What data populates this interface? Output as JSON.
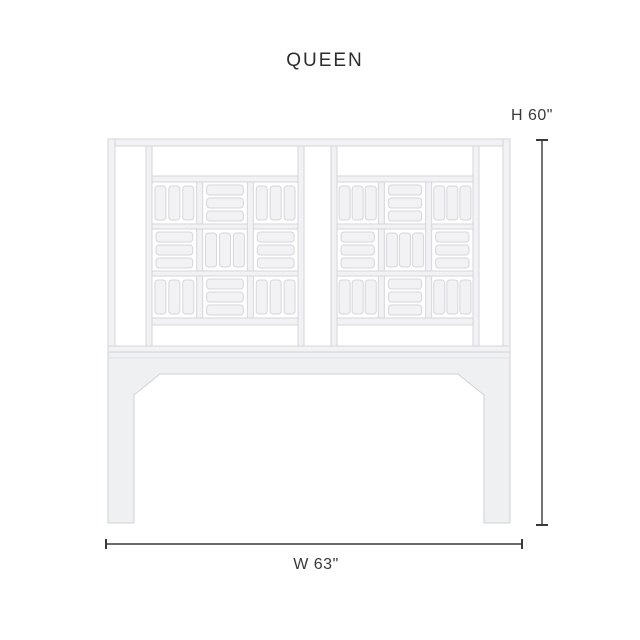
{
  "title": "QUEEN",
  "dimensions": {
    "height_label": "H 60\"",
    "width_label": "W 63\""
  },
  "diagram": {
    "product": "headboard",
    "panel_count": 2,
    "bars_per_cell": 3,
    "lattice_pattern": [
      [
        "V",
        "H",
        "V"
      ],
      [
        "H",
        "V",
        "H"
      ],
      [
        "V",
        "H",
        "V"
      ]
    ],
    "colors": {
      "background": "#ffffff",
      "rail_fill": "#f2f2f4",
      "rail_stroke": "#d6d6db",
      "base_fill": "#eff0f2",
      "base_stroke": "#d2d2d7",
      "dimension_line": "#3a3a3a",
      "text": "#2d2d2d"
    }
  }
}
